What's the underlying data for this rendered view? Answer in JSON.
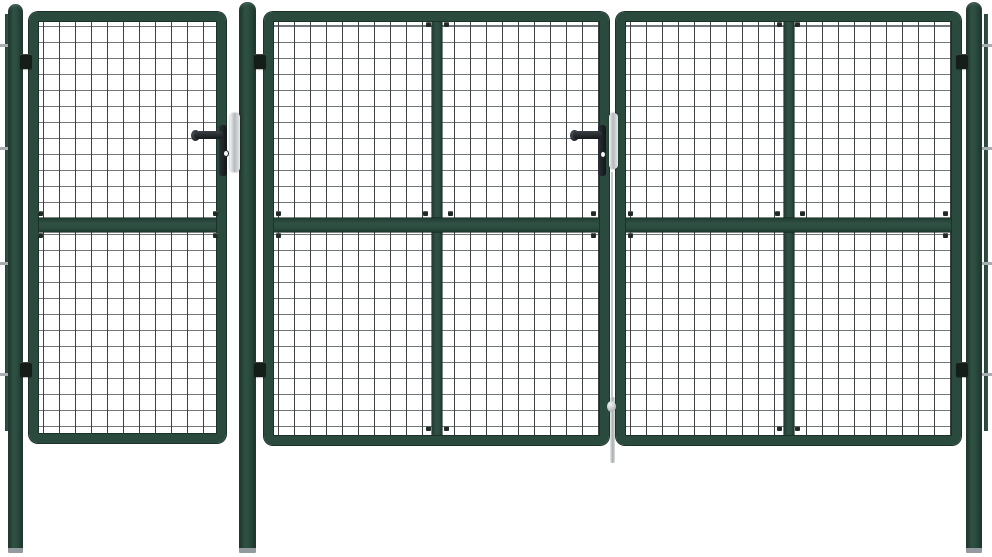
{
  "meta": {
    "type": "product-photo",
    "subject": "Green steel garden gate set with wire mesh infill: single pedestrian gate on the left, wide double driveway gate on the right, three round posts and edge anchor bars"
  },
  "colors": {
    "background": "#ffffff",
    "frame_green": "#2a4a3d",
    "frame_dark": "#1b3129",
    "post_green_edge": "#1d362c",
    "post_green_mid": "#2f5244",
    "mesh_vertical": "#3d4245",
    "mesh_horizontal": "#70767a",
    "hardware_dark": "#1f262a",
    "hardware_silver": "#d7dadc",
    "hardware_silver_hi": "#f1f2f3",
    "ground_shadow": "#939b9e",
    "anchor_gray": "#a7adb0"
  },
  "components": {
    "posts": [
      "left round post",
      "middle round post",
      "right round post"
    ],
    "gates": [
      "pedestrian gate",
      "double gate left panel",
      "double gate right panel"
    ],
    "hardware": [
      "lever handle",
      "lock escutcheon",
      "keyhole",
      "latch strike plate",
      "drop rod",
      "hinges",
      "carriage bolts"
    ],
    "structure": [
      "wire mesh infill",
      "mid rail",
      "center brace bar",
      "wall anchor bars"
    ]
  }
}
